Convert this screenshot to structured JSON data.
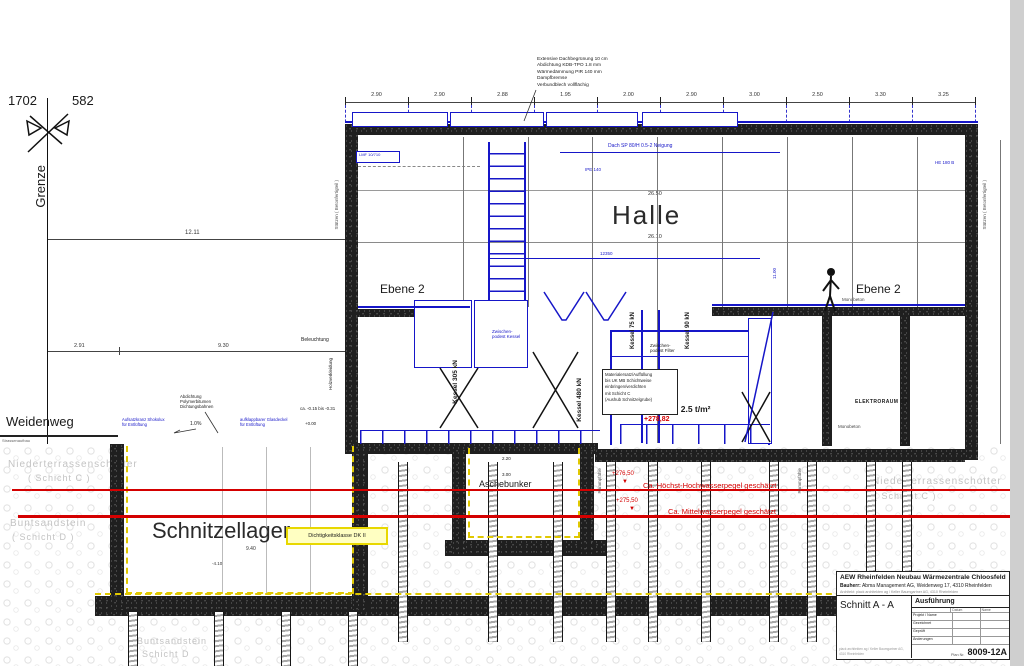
{
  "survey": {
    "parcel_a": "1702",
    "parcel_b": "582",
    "boundary": "Grenze",
    "street": "Weidenweg",
    "street_note": "Strassenaufbau"
  },
  "roof_note_lines": [
    "Extensive Dachbegrünung  10 cm",
    "Abdichtung KDB-TPO  1.8 mm",
    "Wärmedämmung PIR 140 mm",
    "Dampfbremse",
    "Verbundblech vollflächig"
  ],
  "top_dims": [
    "2.90",
    "2.90",
    "2.88",
    "1.95",
    "2.00",
    "2.90",
    "3.00",
    "2.50",
    "3.30",
    "3.25"
  ],
  "dims": {
    "left_total": "12.11",
    "left_a": "2.91",
    "left_b": "9.30",
    "hall_upper": "26.50",
    "hall_lower": "26.10",
    "pit_width": "9.40",
    "pit_neg": "-4.10",
    "bunker_a": "2.20",
    "bunker_b": "3.00",
    "stair_blue": "12350",
    "right_v": "11.00",
    "ground_range": "ca. -0.15  bis -0.31",
    "zero": "+0.00"
  },
  "rooms": {
    "hall": "Halle",
    "level2_left": "Ebene 2",
    "level2_right": "Ebene 2",
    "chip_store": "Schnitzellager",
    "ash_bunker": "Aschebunker",
    "electrical": "ELEKTRORAUM GA"
  },
  "loads": {
    "live_load": "Nutzlast = 2.5 t/m²",
    "level": "+278,82"
  },
  "kessel": [
    "Kessel 305 kN",
    "Kessel 480 kN",
    "Kessel 75 kN",
    "Kessel 90 kN"
  ],
  "water": [
    {
      "elev": "+276,50",
      "label": "Ca. Höchst-Hochwasserpegel geschätzt"
    },
    {
      "elev": "+275,50",
      "label": "Ca. Mittelwasserpegel geschätzt"
    }
  ],
  "soil": {
    "upper": "Niederterrassenschotter",
    "upper_layer": "( Schicht C )",
    "lower": "Buntsandstein",
    "lower_layer": "( Schicht D )",
    "bottom": "Buntsandstein",
    "bottom_layer": "Schicht D"
  },
  "notes": {
    "seal_class": "Dichtigkeitsklasse DK II",
    "material_box": [
      "Materialersatz/Auffüllung",
      "bis UK MB  Schichtweise",
      "einbringen/verdichten",
      "mit Schicht C",
      "(Aushub Schnitzelgrube)"
    ],
    "lighting": "Beleuchtung",
    "wood": "Holzverkleidung",
    "columns_left": "Stützen ( Betonfertigteil )",
    "columns_right": "Stützen ( Betonfertigteil )",
    "abdichtung": [
      "Abdichtung",
      "Polymerbitumen",
      "Dichtungsbahnen"
    ],
    "glass_lid": [
      "aufklappbarer Glasdeckel",
      "für Entlüftung"
    ],
    "vent_curb": [
      "Aufsatzkranz Shokolux",
      "für Entlüftung"
    ],
    "slope": "1.0%",
    "monobeton": "Monobeton",
    "piles": "Rammpfähle",
    "mezz_kessel": [
      "Zwischen-",
      "podest Kessel"
    ],
    "mezz_filter": [
      "Zwischen-",
      "podest Filter"
    ],
    "roof_beam": "Dach SP 80/H 0.5-2 Neigung",
    "beam_lmf": "LMF 10/710",
    "beam_ipe": "IPE 140",
    "beam_he": "HE 180 B"
  },
  "titleblock": {
    "project": "AEW Rheinfelden Neubau Wärmezentrale Chloosfeld",
    "client_label": "Bauherr:",
    "client": "Abma Management AG, Weidenweg 17, 4310 Rheinfelden",
    "architect_label": "Architekt:",
    "architect": "plack architekten ag / Keller Baumgartner AG, 4310 Rheinfelden",
    "sheet": "Schnitt  A - A",
    "phase": "Ausführung",
    "rows": [
      "Projekt / Name",
      "Gezeichnet",
      "Geprüft",
      "Änderungen"
    ],
    "cols": [
      "Datum",
      "Name"
    ],
    "plan_label": "Plan Nr.",
    "plan_no": "8009-12A"
  }
}
